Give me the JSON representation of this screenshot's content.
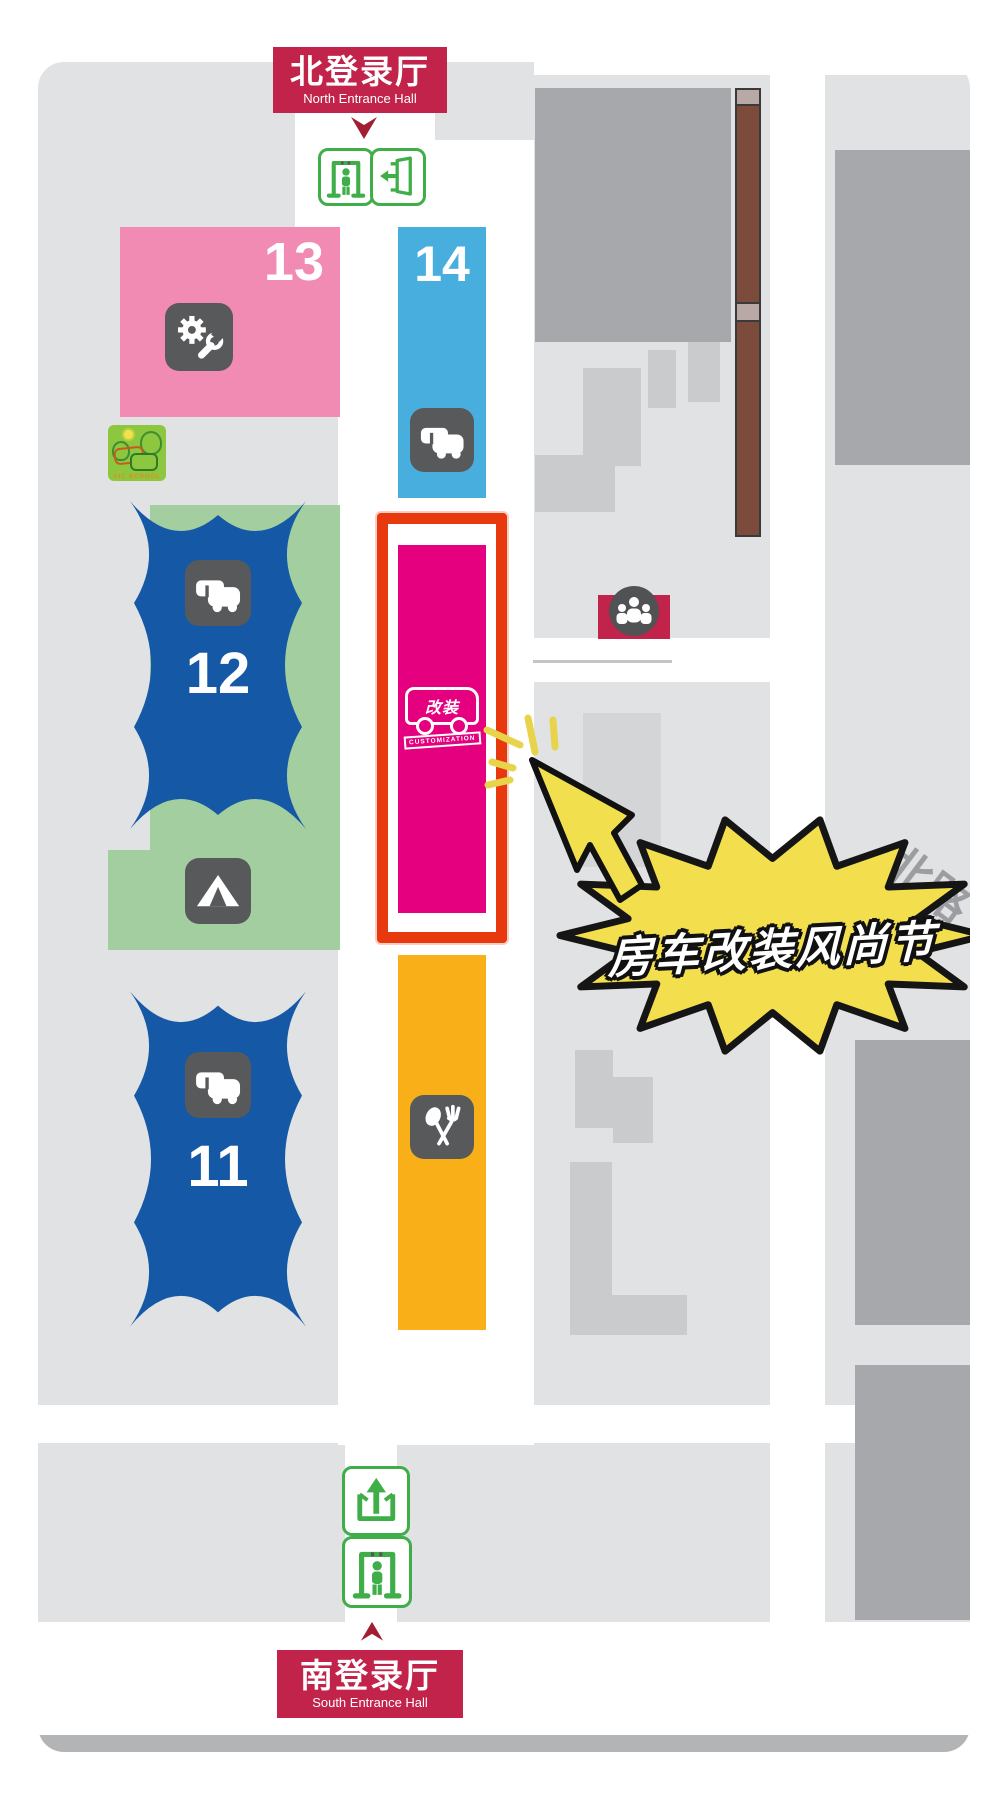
{
  "banners": {
    "north_zh": "北登录厅",
    "north_en": "North Entrance Hall",
    "south_zh": "南登录厅",
    "south_en": "South Entrance Hall"
  },
  "halls": {
    "h13": "13",
    "h14": "14",
    "h12": "12",
    "h11": "11"
  },
  "booth": {
    "vehicle_label": "改装",
    "ribbon": "CUSTOMIZATION"
  },
  "callout": "房车改装风尚节",
  "road_label": "北路",
  "aic_logo": "AIC SCHOOL",
  "icons": {
    "hall13": "gear-wrench-icon",
    "hall14": "rv-icon",
    "hall12": "rv-icon",
    "hall11": "rv-icon",
    "green_area": "tent-icon",
    "food_strip": "fork-spoon-icon",
    "meeting": "meeting-point-icon",
    "north_entrance": [
      "security-gate-icon",
      "exit-door-icon"
    ],
    "south_entrance": [
      "exit-up-icon",
      "security-gate-icon"
    ]
  },
  "colors": {
    "accent_crimson": "#c2234a",
    "hall13_pink": "#f18bb3",
    "hall14_blue": "#47aedd",
    "hall_dark_blue": "#1558a5",
    "green_area": "#a3cfa0",
    "magenta_booth": "#e5007f",
    "highlight_red": "#e8380d",
    "orange_food": "#f9b018",
    "callout_yellow": "#f3df4d",
    "icon_gray": "#58595b",
    "logo_green": "#8dc63f"
  }
}
